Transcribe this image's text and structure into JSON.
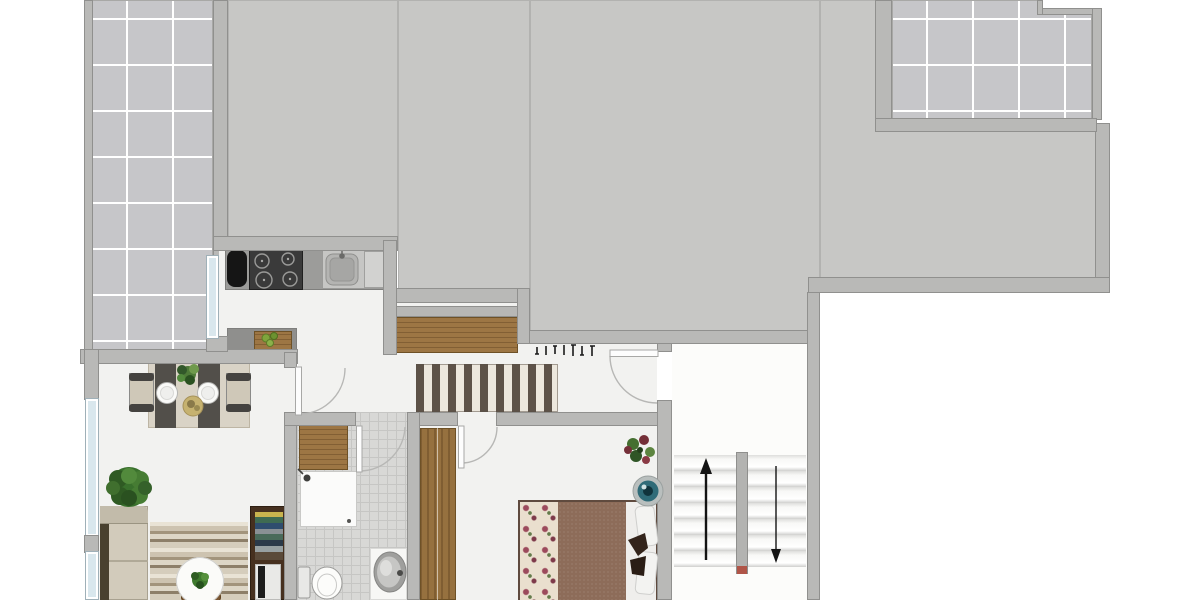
{
  "meta": {
    "type": "residential-floor-plan",
    "visible_text_labels": [],
    "orientation": "top-down"
  },
  "palette": {
    "roof_gray": "#c7c7c5",
    "wall": "#b9b9b7",
    "terrace_tile": "#c6c6c9",
    "interior_floor": "#f2f2f0",
    "bath_tile": "#d8d8d6",
    "window_glass": "#d9e7ed",
    "wood": "#9d7644",
    "duvet": "#8d6c59",
    "arrow": "#141414",
    "accent_bowl_teal": "#2f6b78"
  },
  "rooms": [
    {
      "name": "terrace-top-left",
      "floor": "tile-grid"
    },
    {
      "name": "roof-area",
      "floor": "plain-gray",
      "note": "large unlabeled gray surface spanning top of plan"
    },
    {
      "name": "terrace-top-right",
      "floor": "tile-grid",
      "feature": "notched corner"
    },
    {
      "name": "kitchen",
      "fixtures": [
        "refrigerator",
        "cooktop-4-burners",
        "sink",
        "counter",
        "island-with-cutting-board-and-fruit"
      ],
      "openings": [
        "window-to-terrace",
        "door-to-living-room",
        "open-to-hallway"
      ]
    },
    {
      "name": "living-dining-room",
      "furniture": [
        "dining-table-with-runner",
        "chair-left",
        "chair-right",
        "two-plates",
        "centerpiece-plant",
        "serving-bowl",
        "potted-plant",
        "sofa",
        "striped-rug",
        "round-coffee-table-with-plant",
        "stool",
        "bookshelf-with-books-and-tv"
      ],
      "openings": [
        "two-windows-left-wall"
      ]
    },
    {
      "name": "hallway",
      "furniture": [
        "wooden-sideboard",
        "striped-runner-rug",
        "coat-hooks-7"
      ],
      "openings": [
        "entrance-door-from-stairwell",
        "door-to-bathroom",
        "door-to-bedroom"
      ]
    },
    {
      "name": "bathroom",
      "floor": "small-tile-grid",
      "fixtures": [
        "wooden-cabinet",
        "shower-with-head",
        "toilet",
        "oval-washbasin-with-faucet"
      ]
    },
    {
      "name": "bedroom",
      "furniture": [
        "wooden-wardrobe",
        "double-bed-floral-and-brown-bedding",
        "pillows",
        "flower-plant",
        "teal-decorative-bowl"
      ]
    },
    {
      "name": "staircase",
      "features": [
        "up-flight",
        "down-flight",
        "center-divider-wall",
        "red-divider-tip"
      ]
    }
  ],
  "stairs": {
    "flights": 2,
    "treads_per_flight": 7,
    "direction_arrows": [
      "up",
      "down"
    ],
    "up_arrow_glyph": "↑",
    "down_arrow_glyph": "↓"
  },
  "icons": [
    "up-arrow-icon",
    "down-arrow-icon",
    "shower-head-icon",
    "coat-hook-icon",
    "door-swing-arc-icon",
    "cooktop-burner-icon"
  ]
}
